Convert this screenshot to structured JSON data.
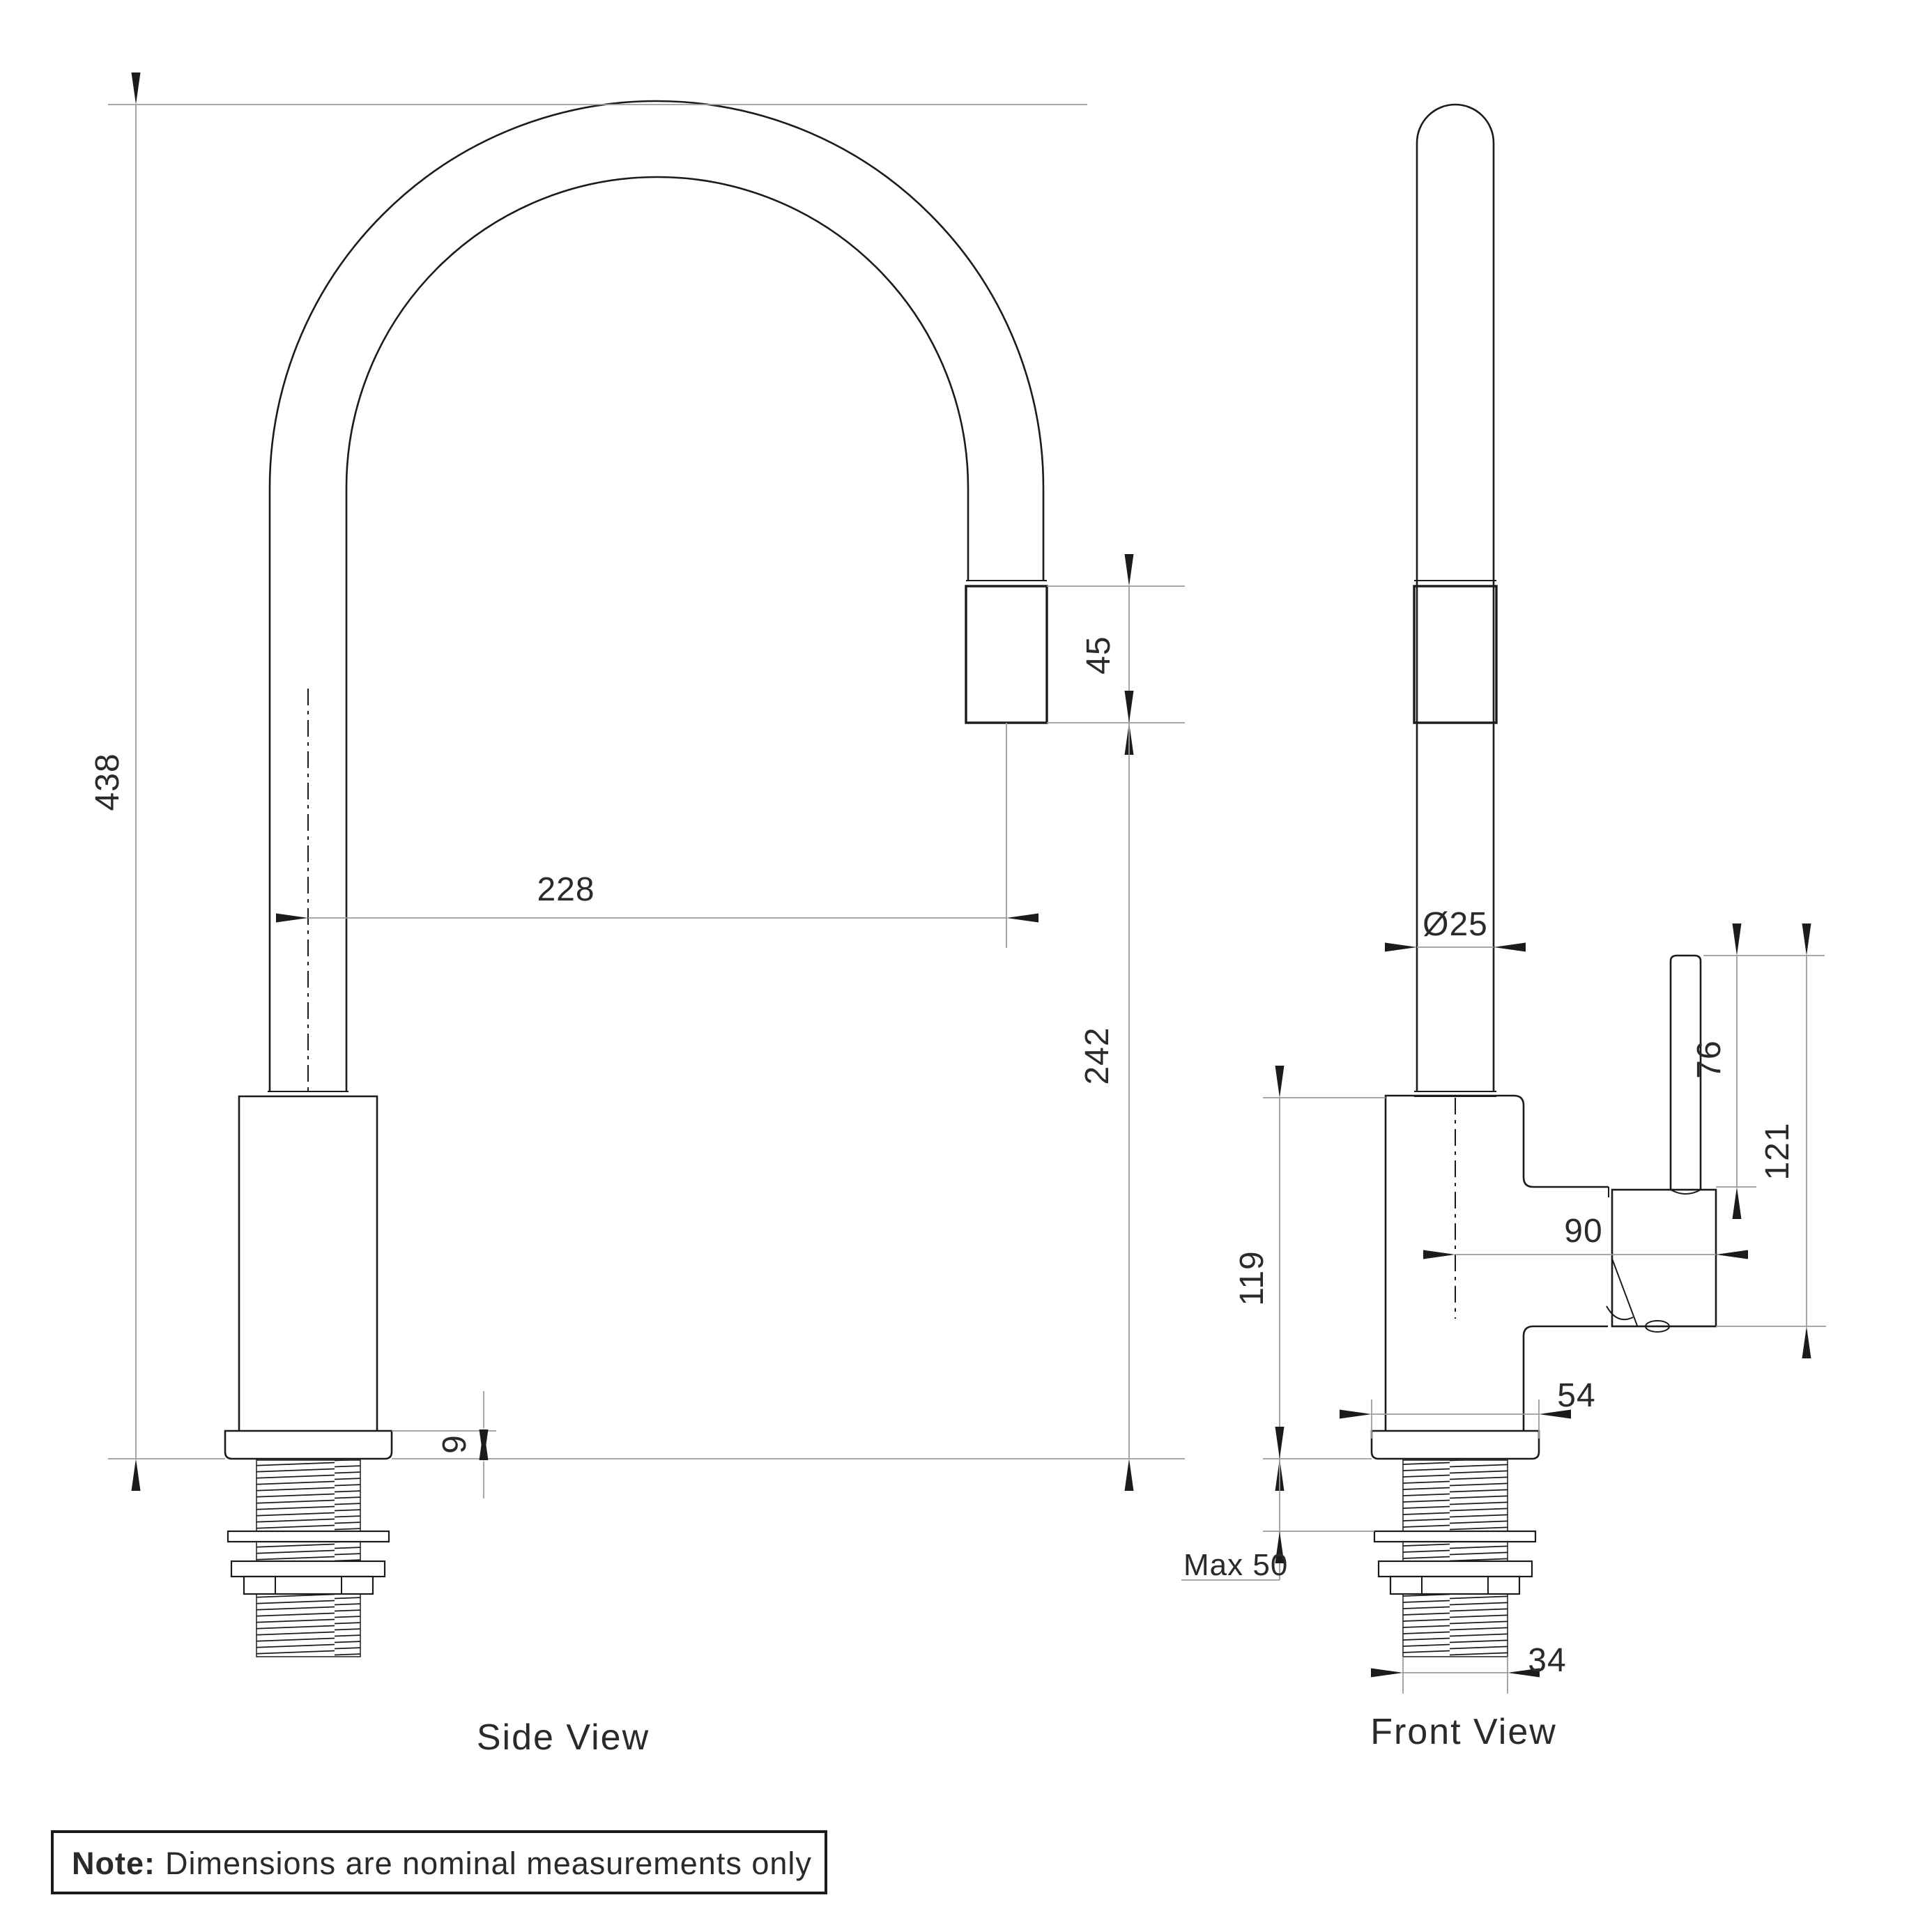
{
  "side_view": {
    "label": "Side View",
    "dims": {
      "overall_height": "438",
      "spout_reach": "228",
      "spout_tip_length": "45",
      "spout_clearance": "242",
      "base_plate_thickness": "9"
    }
  },
  "front_view": {
    "label": "Front View",
    "dims": {
      "spout_diameter": "Ø25",
      "handle_lever_length": "76",
      "handle_overall_height": "121",
      "handle_reach": "90",
      "body_height": "119",
      "base_width": "54",
      "max_bench_thickness": "Max 50",
      "shank_width": "34"
    }
  },
  "note": {
    "bold": "Note:",
    "text": "Dimensions are nominal measurements only"
  },
  "colors": {
    "outline": "#1b1b1b",
    "dimension_line": "#9c9c9c",
    "text": "#2a2a2a",
    "background": "#ffffff"
  }
}
